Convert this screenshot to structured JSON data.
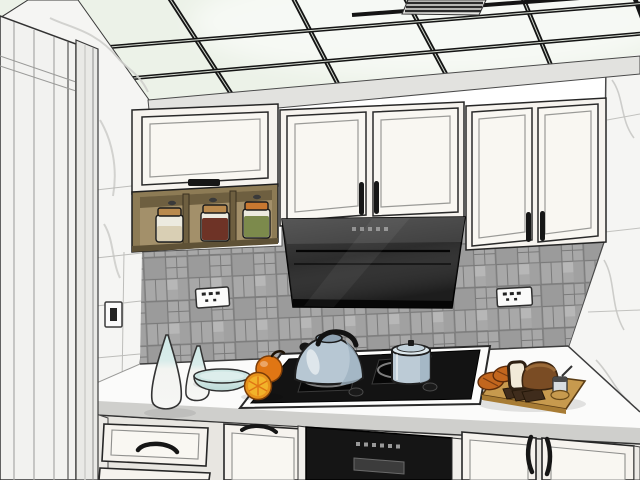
{
  "meta": {
    "title": "3D rendered kitchen interior, SketchUp-style line render, viewed toward the cooktop wall",
    "canvas": {
      "width": 640,
      "height": 480
    }
  },
  "palette": {
    "ceiling_panel": "#ecf2e8",
    "ceiling_grid": "#141414",
    "marble": "#f5f5f3",
    "marble_vein": "#cfcfcc",
    "soffit": "#e2e2df",
    "door": "#f2f2f0",
    "door_casing": "#e9e9e6",
    "cabinet_face": "#f6f3ee",
    "cabinet_panel": "#f9f7f2",
    "handle_dark": "#161616",
    "wood_face": "#8d7b55",
    "wood_interior": "#a3906a",
    "wood_dark": "#6e5f40",
    "jar_lid_tan": "#b98a4e",
    "jar_lid_orange": "#c87830",
    "jar_glass": "#eceadf",
    "jar_beige": "#d9cfb4",
    "jar_red": "#6e3326",
    "jar_green": "#7c8a4c",
    "tile_base": "#a8a8a8",
    "tile_line": "#767676",
    "outlet_white": "#fbfbfa",
    "hood_black": "#262626",
    "hood_top": "#3c3c3c",
    "counter_top": "#fbfbfa",
    "counter_edge": "#cfcfcc",
    "cooktop_black": "#131313",
    "burner_gray": "#7e7e7e",
    "oven_black": "#151515",
    "oven_handle": "#3c3c3c",
    "kettle_body": "#b7c7d3",
    "kettle_shade": "#9fb3c2",
    "pot_body": "#bccbd6",
    "pot_rim": "#dde8ed",
    "vase_white": "#f6f6f4",
    "vase_teal": "#cfe8e6",
    "bowl_teal": "#cde6e3",
    "orange_rind": "#e07614",
    "orange_flesh": "#f2b32a",
    "board_top": "#c79a4e",
    "board_side": "#a87c34",
    "bread_crust": "#7a4c24",
    "bread_top": "#9a6a38",
    "slice_dark": "#3f2c1c",
    "slice_face": "#f2ead8",
    "roll_orange": "#c2661e",
    "switch_white": "#fafafa"
  },
  "objects": [
    {
      "id": "ceiling",
      "label": "Suspended ceiling of glowing light-green glass panels in a black T-bar grid"
    },
    {
      "id": "ceiling-vent",
      "label": "Dark slatted vent grille set in one ceiling panel"
    },
    {
      "id": "left-door",
      "label": "White paneled door with vertical joints, left foreground"
    },
    {
      "id": "left-wall",
      "label": "White marble tiled wall between door and cabinets"
    },
    {
      "id": "light-switch",
      "label": "Small wall switch on the left marble wall"
    },
    {
      "id": "soffit",
      "label": "Light gray soffit beam above the wall cabinets"
    },
    {
      "id": "right-wall",
      "label": "White marble wall at the right side"
    },
    {
      "id": "upper-cabinet-left",
      "label": "White flip-up wall cabinet over an open wood spice shelf"
    },
    {
      "id": "spice-jars",
      "label": "Three jars on the open shelf: beige, dark red, green contents"
    },
    {
      "id": "upper-cabinet-middle",
      "label": "Two white framed wall cabinet doors above the range hood"
    },
    {
      "id": "upper-cabinet-right",
      "label": "Two taller white framed wall cabinet doors at right"
    },
    {
      "id": "range-hood",
      "label": "Black angled range hood with small control buttons"
    },
    {
      "id": "backsplash",
      "label": "Gray mosaic tile backsplash"
    },
    {
      "id": "outlet-left",
      "label": "White power outlet on backsplash, left of hood"
    },
    {
      "id": "outlet-right",
      "label": "White power outlet on backsplash, right of hood"
    },
    {
      "id": "countertop",
      "label": "White countertop running along the back wall"
    },
    {
      "id": "cooktop",
      "label": "Black two-burner gas cooktop with white rim"
    },
    {
      "id": "kettle",
      "label": "Light blue whistling kettle with black handle on left burner"
    },
    {
      "id": "pot",
      "label": "Light blue lidded pot on right burner"
    },
    {
      "id": "vases",
      "label": "Two teardrop vases, white with pale teal tops"
    },
    {
      "id": "bowl",
      "label": "Shallow pale teal bowl"
    },
    {
      "id": "oranges",
      "label": "Whole orange and a cut orange half"
    },
    {
      "id": "cutting-board",
      "label": "Wooden cutting board with bread loaf, slices, rolls and a small jar"
    },
    {
      "id": "oven",
      "label": "Black built-in oven below the cooktop"
    },
    {
      "id": "lower-cabinets",
      "label": "White lower cabinets and drawers with dark handles"
    }
  ]
}
